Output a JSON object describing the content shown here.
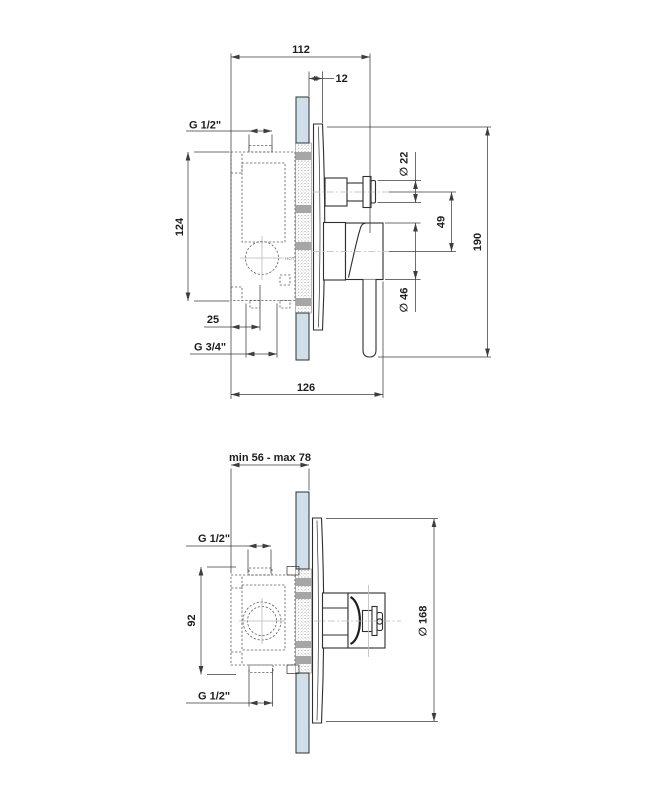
{
  "drawing": {
    "description": "Concealed shower mixer valve installation dimensions, two side section views",
    "colors": {
      "outline": "#2f2f2f",
      "dimension_line": "#3d3d3d",
      "text": "#1d1d1d",
      "hidden_line": "#5f5f5f",
      "centerline": "#b9b9b9",
      "wall_tile_fill": "#cfe0ea",
      "plaster_band": "#a6a6a6",
      "background": "#ffffff"
    },
    "top_view": {
      "labels": {
        "total_depth_to_knob": "112",
        "plate_offset": "12",
        "outlet_thread": "G 1/2\"",
        "body_height": "124",
        "inlet_offset": "25",
        "inlet_thread": "G 3/4\"",
        "total_depth_to_handle": "126",
        "knob_diameter": "∅ 22",
        "axis_distance": "49",
        "handle_diameter": "∅ 46",
        "total_height": "190",
        "hot_marker": "HOT"
      }
    },
    "bottom_view": {
      "labels": {
        "recess_depth_range": "min 56 - max 78",
        "top_thread": "G 1/2\"",
        "body_height": "92",
        "bottom_thread": "G 1/2\"",
        "plate_diameter": "∅ 168"
      }
    }
  }
}
